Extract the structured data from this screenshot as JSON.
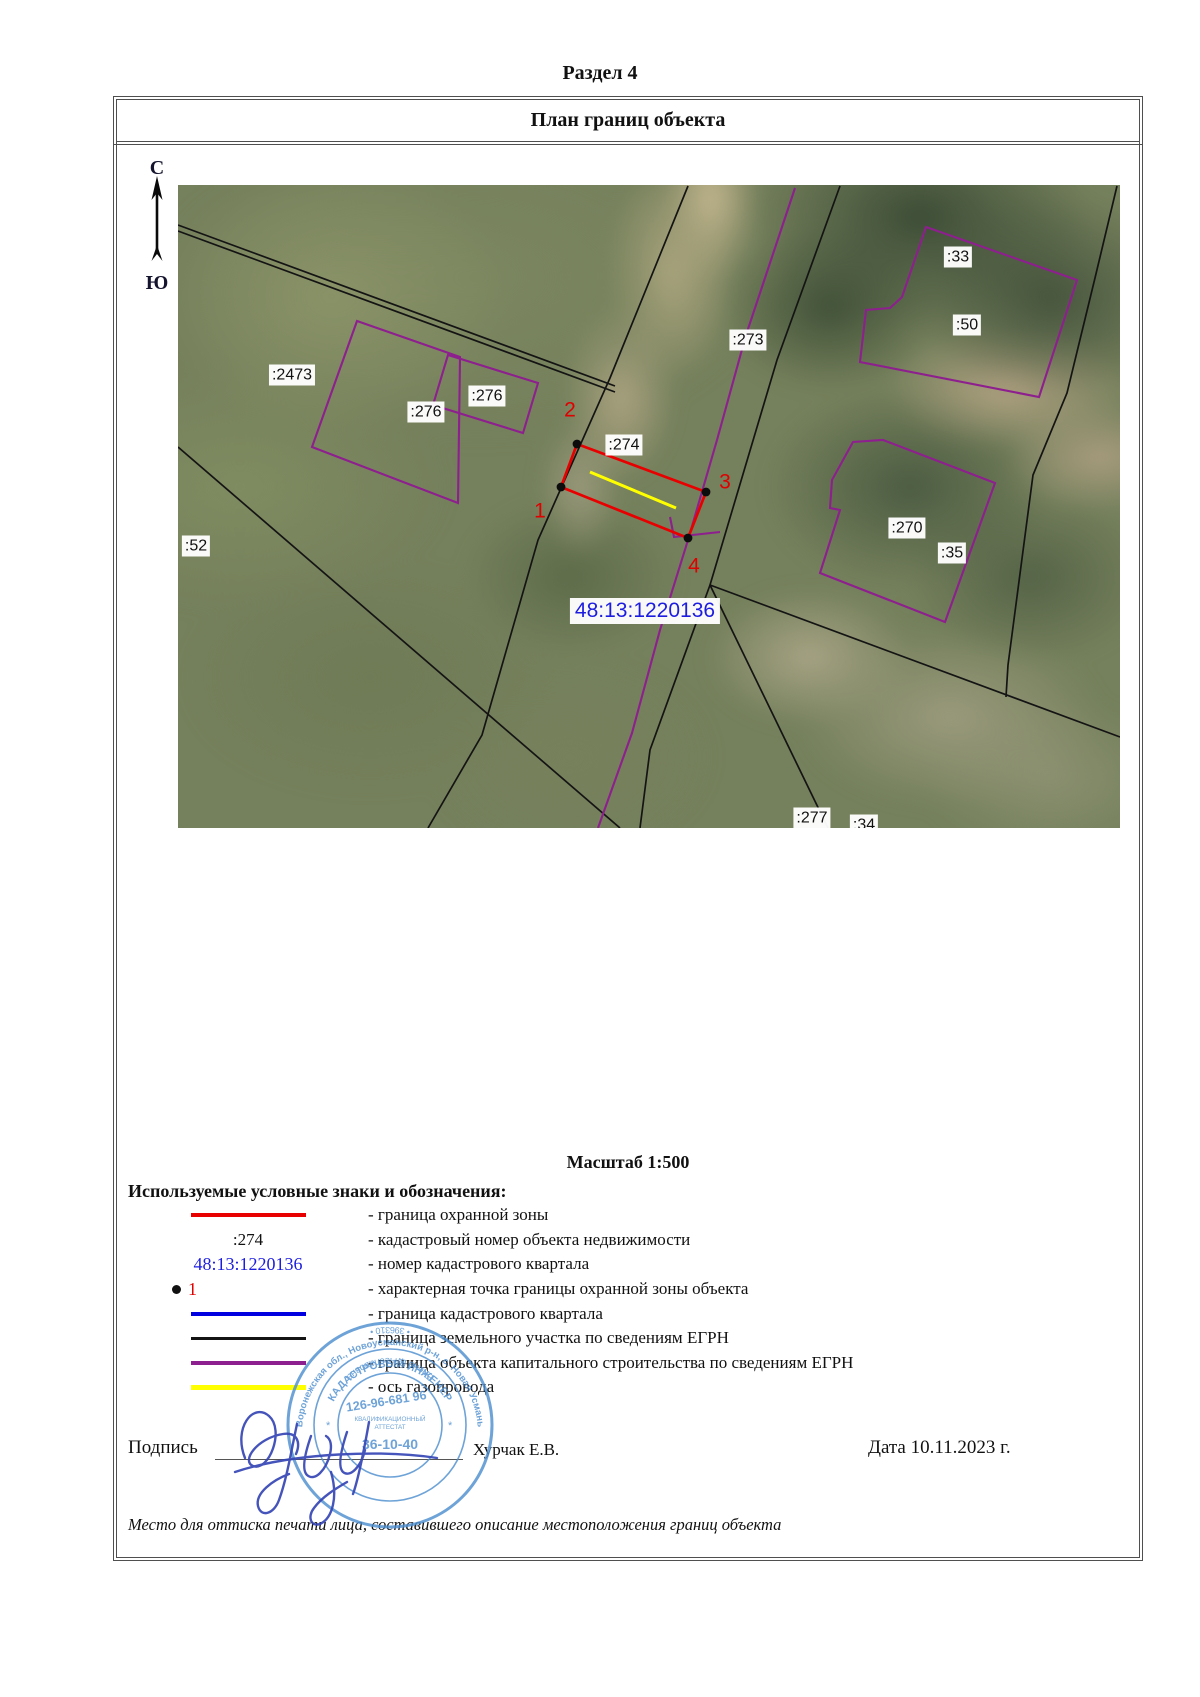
{
  "document": {
    "section_title": "Раздел 4",
    "plan_title": "План границ объекта",
    "scale_label": "Масштаб 1:500",
    "footer_note": "Место для оттиска печати лица, составившего описание местоположения границ объекта"
  },
  "compass": {
    "north_label": "С",
    "south_label": "Ю"
  },
  "map": {
    "quarter_label": {
      "text": "48:13:1220136",
      "x": 467,
      "y": 426
    },
    "parcel_labels": [
      {
        "text": ":2473",
        "x": 114,
        "y": 190
      },
      {
        "text": ":276",
        "x": 248,
        "y": 227
      },
      {
        "text": ":276",
        "x": 309,
        "y": 211
      },
      {
        "text": ":274",
        "x": 446,
        "y": 260
      },
      {
        "text": ":273",
        "x": 570,
        "y": 155
      },
      {
        "text": ":33",
        "x": 780,
        "y": 72
      },
      {
        "text": ":50",
        "x": 789,
        "y": 140
      },
      {
        "text": ":270",
        "x": 729,
        "y": 343
      },
      {
        "text": ":35",
        "x": 774,
        "y": 368
      },
      {
        "text": ":52",
        "x": 18,
        "y": 361
      },
      {
        "text": ":277",
        "x": 634,
        "y": 633
      },
      {
        "text": ":34",
        "x": 686,
        "y": 640
      }
    ],
    "boundary_points": [
      {
        "text": "1",
        "x": 362,
        "y": 326
      },
      {
        "text": "2",
        "x": 392,
        "y": 225
      },
      {
        "text": "3",
        "x": 547,
        "y": 297
      },
      {
        "text": "4",
        "x": 516,
        "y": 381
      }
    ]
  },
  "legend": {
    "header": "Используемые условные знаки и обозначения:",
    "rows": [
      {
        "symbol": "line-red",
        "symbol_text": "",
        "text": "- граница охранной зоны"
      },
      {
        "symbol": "text-black",
        "symbol_text": ":274",
        "text": "- кадастровый номер объекта недвижимости"
      },
      {
        "symbol": "text-blue",
        "symbol_text": "48:13:1220136",
        "text": "- номер кадастрового квартала"
      },
      {
        "symbol": "point",
        "symbol_text": "1",
        "text": "- характерная точка границы охранной зоны объекта"
      },
      {
        "symbol": "line-blue",
        "symbol_text": "",
        "text": "- граница кадастрового квартала"
      },
      {
        "symbol": "line-black",
        "symbol_text": "",
        "text": "- граница земельного участка по сведениям ЕГРН"
      },
      {
        "symbol": "line-purple",
        "symbol_text": "",
        "text": "- граница объекта капитального строительства по сведениям ЕГРН"
      },
      {
        "symbol": "line-yellow",
        "symbol_text": "",
        "text": "- ось газопровода"
      }
    ]
  },
  "signature": {
    "label": "Подпись",
    "name": "Хурчак Е.В.",
    "date": "Дата 10.11.2023 г."
  },
  "stamp": {
    "outer_text_top": "Воронежская обл., Новоусманский р-н, с. Новая Усмань",
    "outer_text_bottom": "• 396310 •",
    "ring_text_top": "КАДАСТРОВЫЙ ИНЖЕНЕР",
    "ring_text_bottom": "Елена Вячеславовна",
    "center_line1": "126-96-681 96",
    "center_line2": "КВАЛИФИКАЦИОННЫЙ",
    "center_line3": "АТТЕСТАТ",
    "center_line4": "36-10-40"
  },
  "colors": {
    "protection_zone": "#e80000",
    "quarter_boundary": "#0000e0",
    "parcel_boundary": "#141414",
    "construction_boundary": "#8e1f8e",
    "pipeline_axis": "#ffff00",
    "quarter_number_text": "#1d1de0",
    "point_number_text": "#e00000",
    "stamp_blue": "#4f8fd0"
  }
}
